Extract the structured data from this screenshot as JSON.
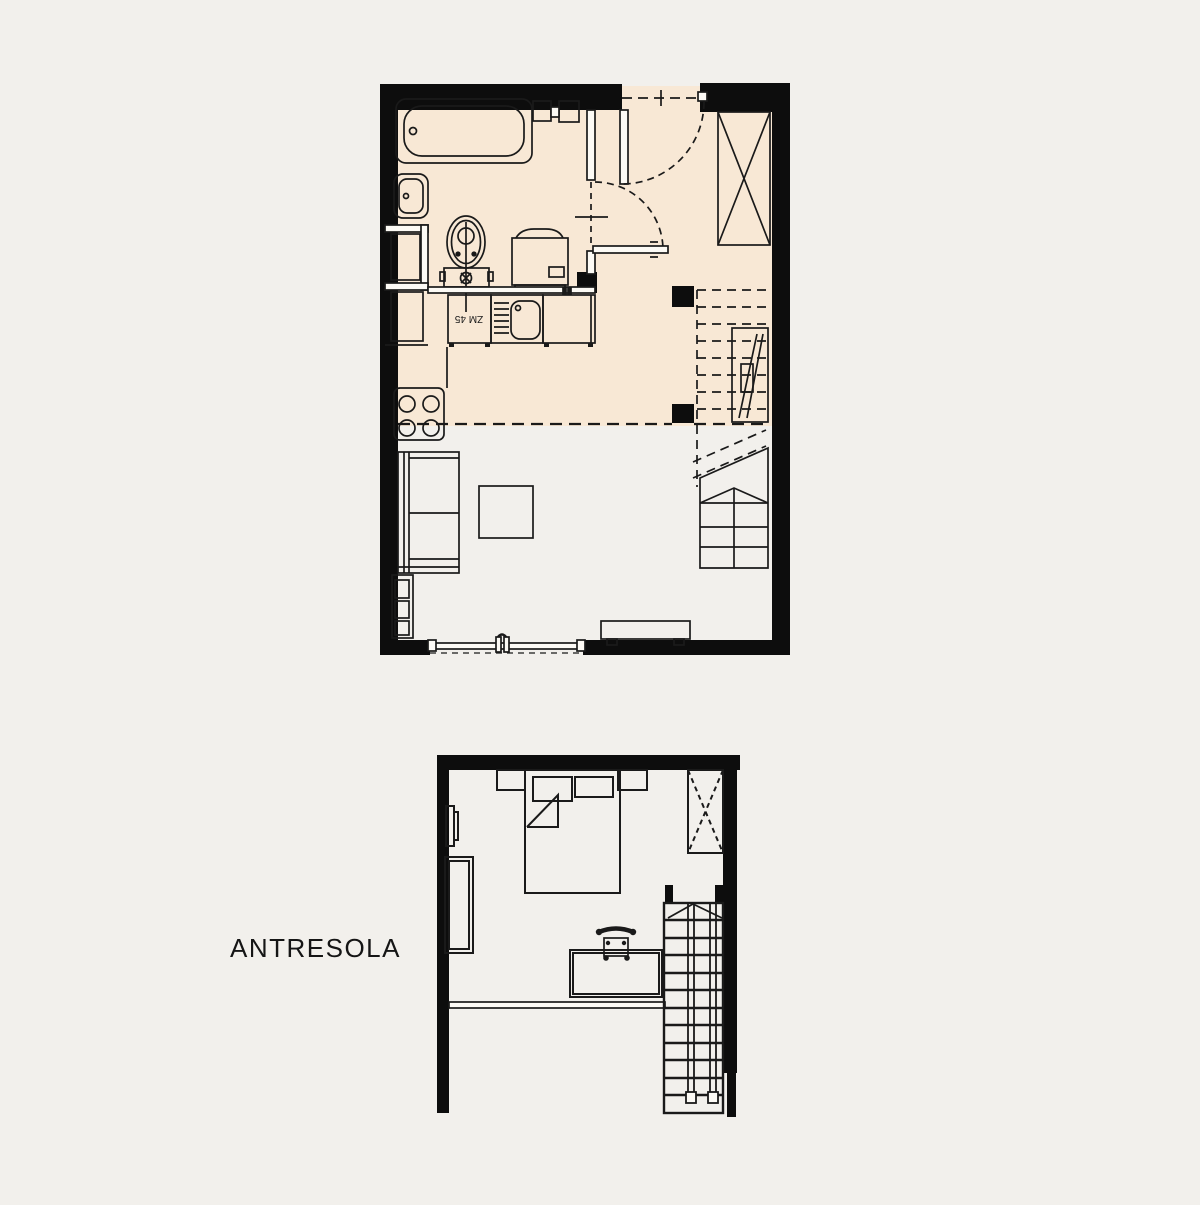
{
  "canvas": {
    "background": "#f2f0ec",
    "width": 1200,
    "height": 1200
  },
  "palette": {
    "wall_fill": "#0d0d0d",
    "line": "#1a1a1a",
    "highlight_floor": "#f8e8d5",
    "paper_white": "#fcfaf5"
  },
  "labels": {
    "mezzanine_title": "ANTRESOLA",
    "dishwasher_unit": "ZM 45"
  },
  "plans": [
    {
      "name": "main-floor",
      "highlighted_zone": "bathroom-kitchen-entry",
      "fixtures": [
        "bathtub",
        "washbasin",
        "toilet",
        "washing-machine",
        "dishwasher-ZM-45",
        "kitchen-sink-with-drainer",
        "kitchen-cabinet",
        "stove-4-burners",
        "tall-cabinets",
        "entry-door",
        "bathroom-door",
        "wardrobe-crossed",
        "overhead-stairs-dashed",
        "ladder",
        "under-stair-shelving",
        "sofa",
        "coffee-table",
        "side-shelf",
        "bench",
        "balcony-window"
      ]
    },
    {
      "name": "mezzanine",
      "fixtures": [
        "double-bed",
        "pillow-left",
        "pillow-right",
        "folded-blanket",
        "nightstand-left",
        "nightstand-right",
        "wardrobe-crossed",
        "wall-mirror",
        "dresser",
        "desk",
        "chair",
        "mezzanine-railing",
        "stairs-down"
      ]
    }
  ]
}
